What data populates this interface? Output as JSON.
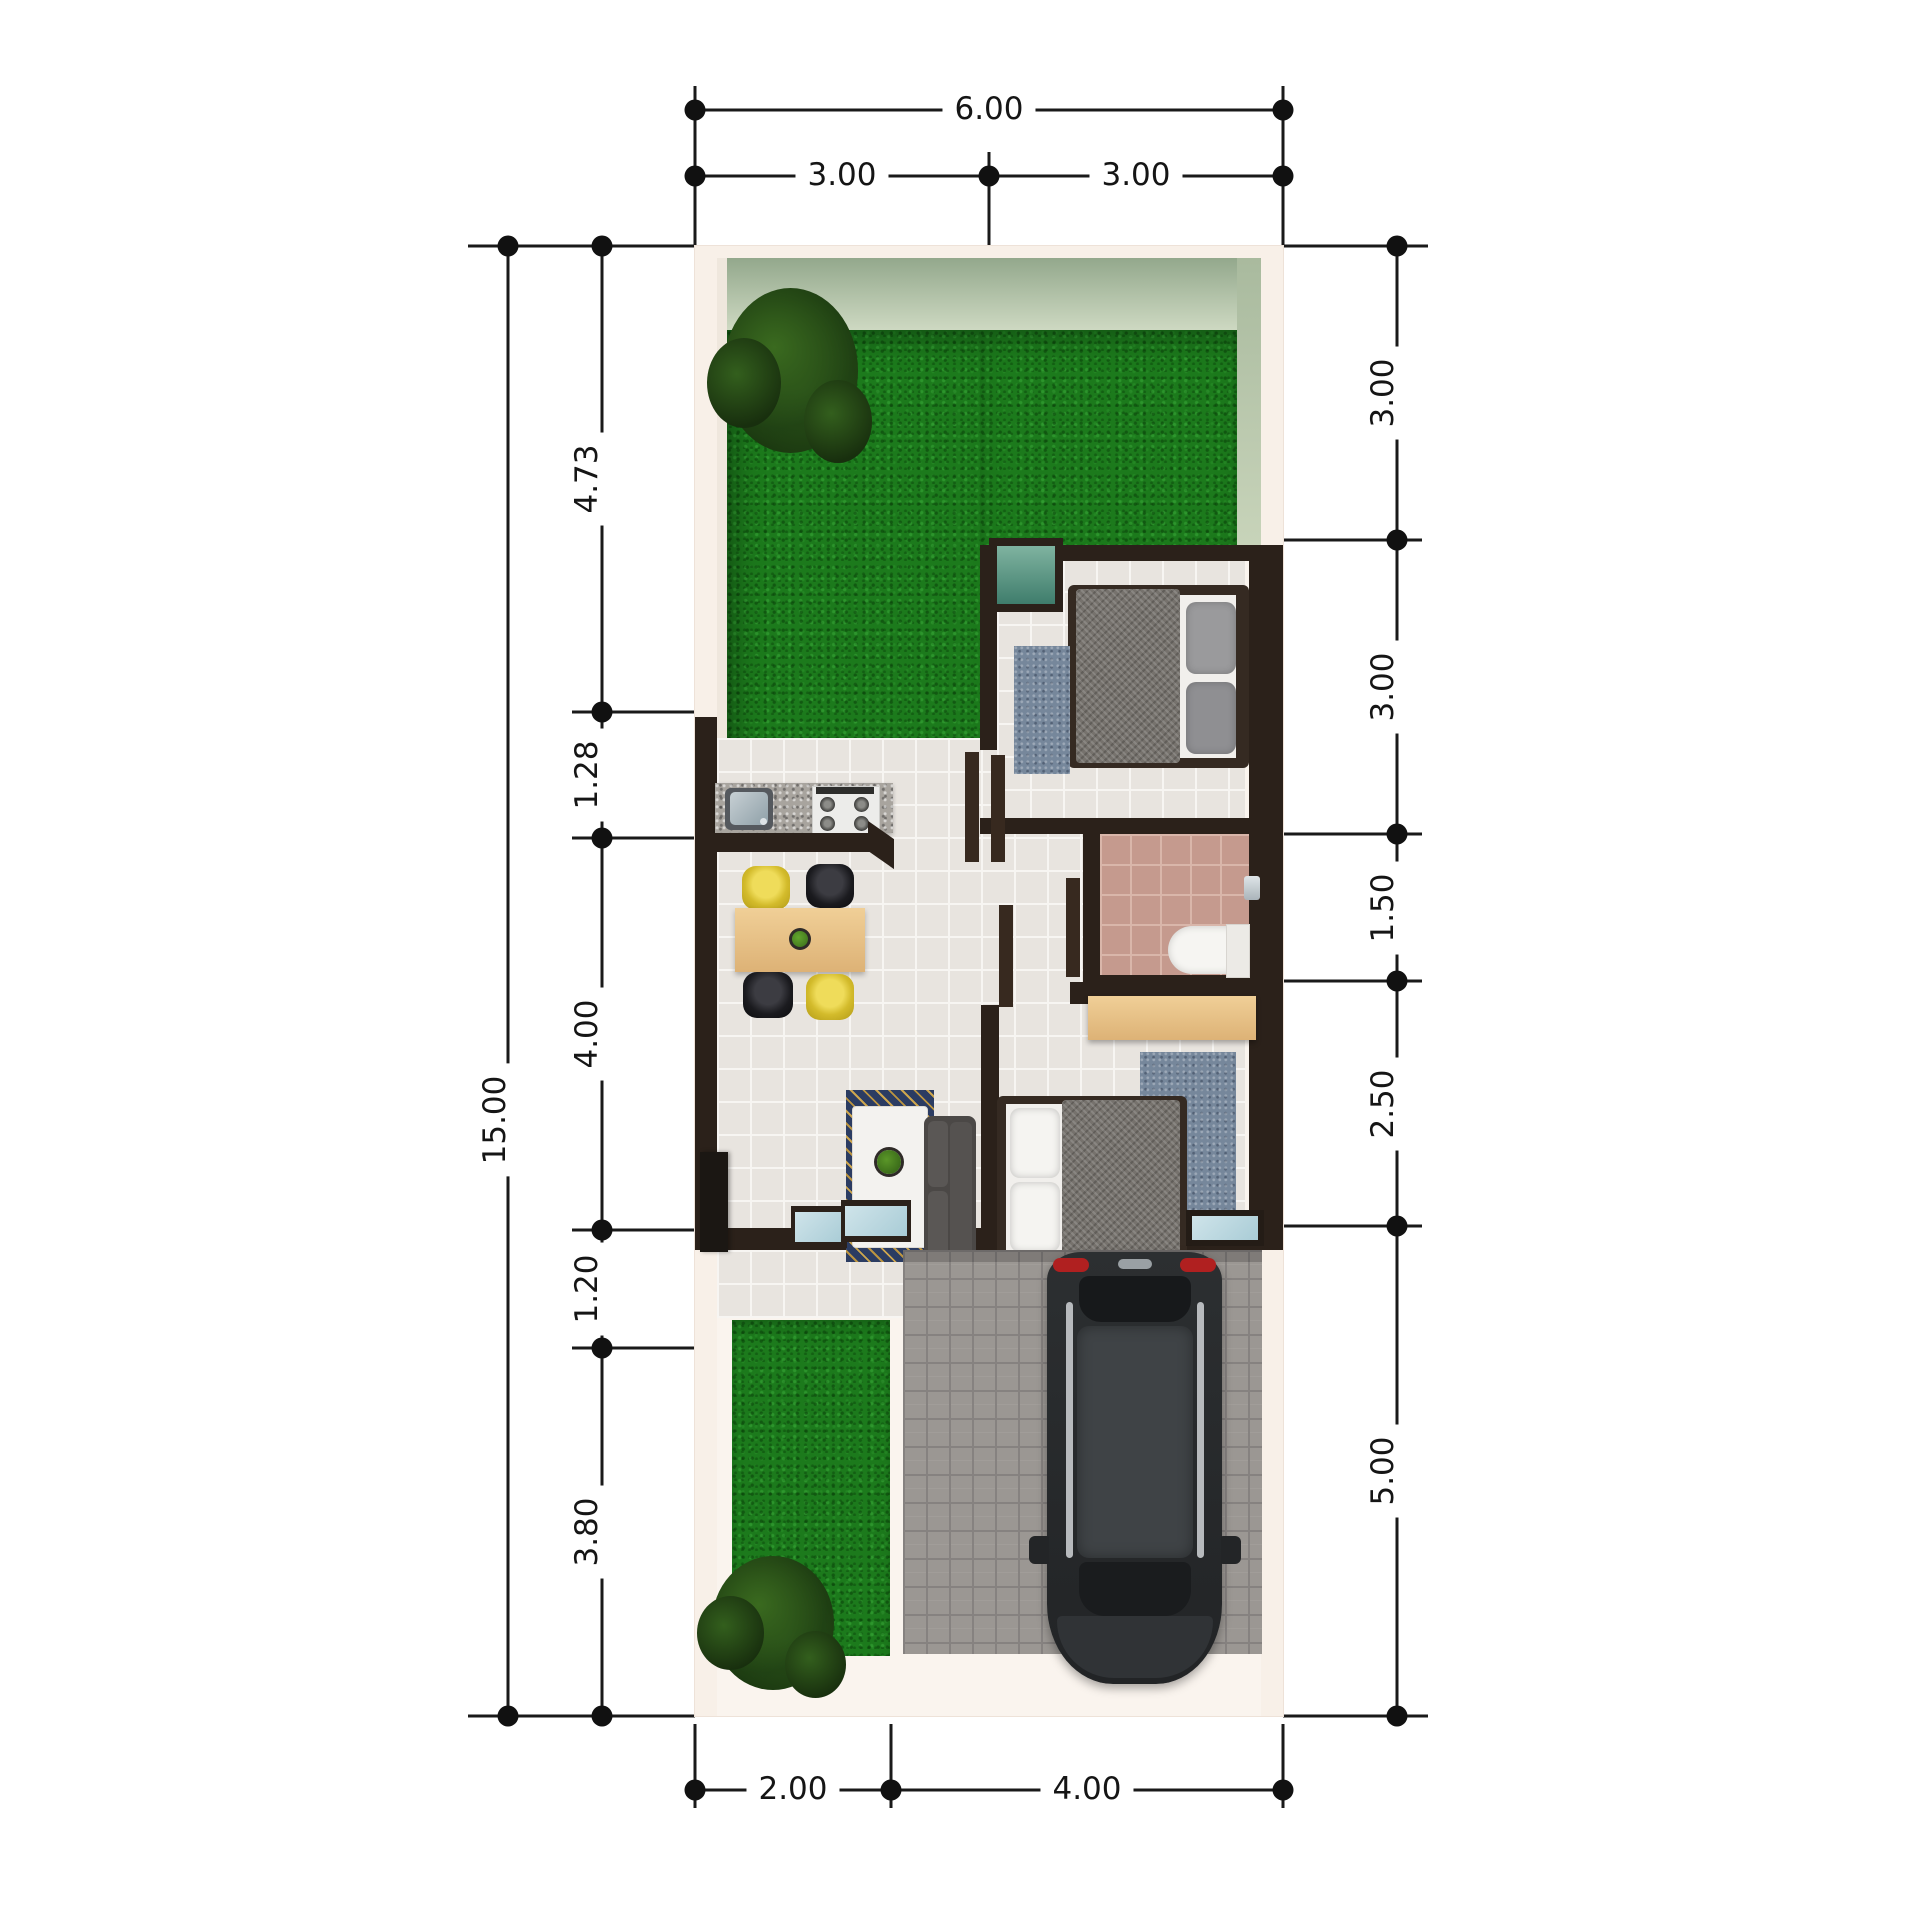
{
  "drawing": {
    "kind": "residential floor plan, top-down 3D render with dimension chains",
    "units_note": "dimension figures as printed on the drawing"
  },
  "dims": {
    "top": {
      "overall": "6.00",
      "segments": [
        "3.00",
        "3.00"
      ]
    },
    "left": {
      "overall": "15.00",
      "segments": [
        "4.73",
        "1.28",
        "4.00",
        "1.20",
        "3.80"
      ]
    },
    "right": {
      "segments": [
        "3.00",
        "3.00",
        "1.50",
        "2.50",
        "5.00"
      ]
    },
    "bottom": {
      "segments": [
        "2.00",
        "4.00"
      ]
    }
  },
  "colors": {
    "background": "#ffffff",
    "dimension_ink": "#1a1a1a",
    "wall_dark": "#2b211a",
    "plot_band": "#f8f0e8",
    "wall_face_green": "#a3b498",
    "grass": "#1c7a1c",
    "floor_tile": "#e8e4df",
    "bathroom_tile": "#c59a8e",
    "carport_paving": "#9b9793",
    "counter_granite": "#a8a49e",
    "furniture_wood": "#e6c183",
    "chair_yellow": "#d3bb2b",
    "chair_black": "#1b1b1f",
    "bed_blanket_grey": "#76726d",
    "rug_blue": "#76879b",
    "batik_blue": "#2b3c62",
    "batik_gold": "#bb9440",
    "window_teal": "#4a8577",
    "glass_light_blue": "#b9d6de",
    "car_body": "#26282a",
    "car_taillight_red": "#b02020"
  }
}
